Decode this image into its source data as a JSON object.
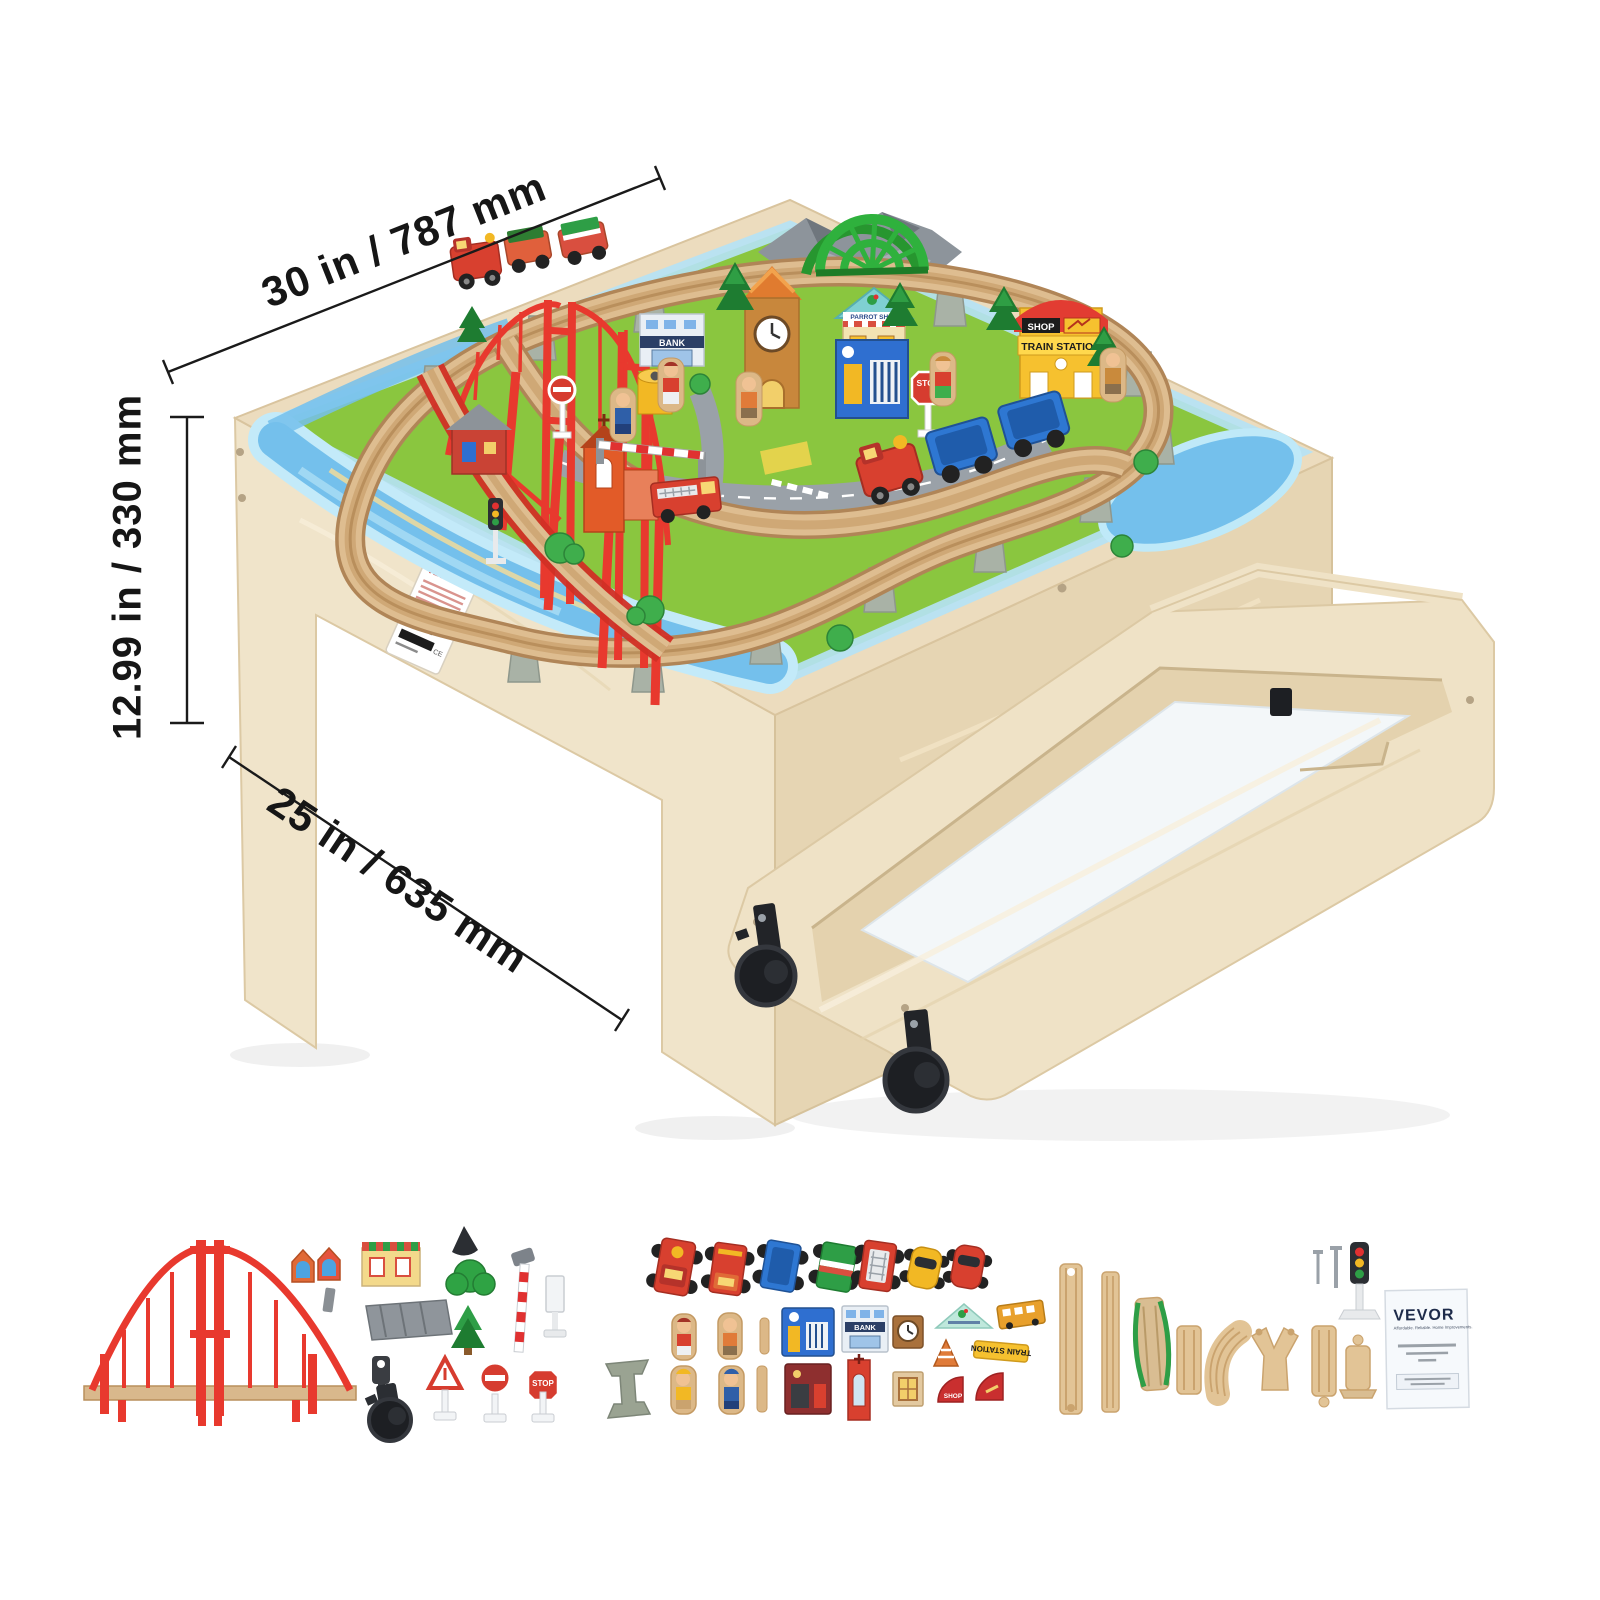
{
  "page": {
    "background": "#ffffff"
  },
  "annotations": {
    "width_label": "30 in / 787 mm",
    "height_label": "12.99 in / 330 mm",
    "depth_label": "25 in / 635 mm",
    "line_color": "#1a1a1a"
  },
  "product": {
    "type": "kids wooden train table with pull-out storage drawer",
    "scene_labels": {
      "bank": "BANK",
      "shop": "SHOP",
      "train_station": "TRAIN STATION",
      "stop_sign": "STOP",
      "parrot_shop": "PARROT SHOP"
    },
    "sticker": {
      "brand": "VEVOR"
    }
  },
  "accessories": {
    "stop_sign_label": "STOP",
    "train_station_sign_label": "TRAIN STATION",
    "shop_tile_label": "SHOP",
    "bank_tile_label": "BANK",
    "manual": {
      "brand": "VEVOR",
      "tagline": "Affordable. Reliable. Home Improvements."
    },
    "items": [
      "suspension-bridge",
      "house-roof-tiles",
      "shop-building-tile",
      "tunnel-cone",
      "bush",
      "station-platform",
      "pine-tree",
      "crossing-signal-pole",
      "road-sign-white",
      "drawer-lock-key",
      "caster-wheel",
      "warning-triangle-sign",
      "no-entry-sign",
      "stop-sign",
      "train-engine",
      "freight-truck",
      "blue-wagon",
      "green-wagon",
      "fire-truck",
      "yellow-car",
      "red-car",
      "track-trestle",
      "figure-woman",
      "figure-man",
      "figure-builder",
      "figure-policeman",
      "wooden-pegs",
      "police-station-tile",
      "bank-tile",
      "clock-tile",
      "fire-station-tile",
      "church-tile",
      "window-tile",
      "parrot-shop-sign",
      "traffic-cone",
      "train-station-sign",
      "school-bus-tile",
      "shop-corner-tiles",
      "straight-tracks",
      "climbing-track",
      "short-track",
      "curved-track",
      "y-switch-track",
      "ramp-track",
      "screws",
      "traffic-light",
      "instruction-manual"
    ]
  },
  "colors": {
    "wood": "#ecdcc0",
    "accent_red": "#e8392e",
    "grass": "#8ac63f",
    "water": "#7ac2ec",
    "track": "#ddbc8e",
    "brand_navy": "#1e2b4a"
  }
}
